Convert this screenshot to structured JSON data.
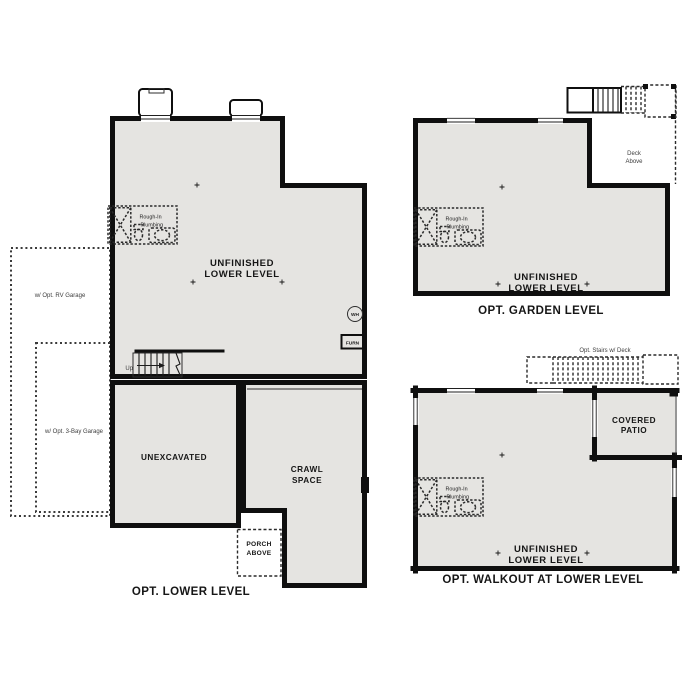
{
  "colors": {
    "wall": "#0f0f0f",
    "floor": "#e5e4e1",
    "floor_light": "#f2f1ef",
    "dash": "#2a2a2a"
  },
  "plans": {
    "lower": {
      "title": "OPT. LOWER LEVEL",
      "labels": {
        "unfinished_1": "UNFINISHED",
        "unfinished_2": "LOWER LEVEL",
        "unexcavated": "UNEXCAVATED",
        "crawl_1": "CRAWL",
        "crawl_2": "SPACE",
        "porch_1": "PORCH",
        "porch_2": "ABOVE"
      },
      "annotations": {
        "rough_in_1": "Rough-In",
        "rough_in_2": "Plumbing",
        "rv_garage": "w/ Opt. RV Garage",
        "three_bay_garage": "w/ Opt. 3-Bay Garage",
        "up": "Up",
        "water_heater": "WH",
        "furnace": "FURN"
      }
    },
    "garden": {
      "title": "OPT. GARDEN LEVEL",
      "labels": {
        "unfinished_1": "UNFINISHED",
        "unfinished_2": "LOWER LEVEL",
        "deck_1": "Deck",
        "deck_2": "Above"
      },
      "annotations": {
        "rough_in_1": "Rough-In",
        "rough_in_2": "Plumbing"
      }
    },
    "walkout": {
      "title": "OPT. WALKOUT AT LOWER LEVEL",
      "labels": {
        "unfinished_1": "UNFINISHED",
        "unfinished_2": "LOWER LEVEL",
        "patio_1": "COVERED",
        "patio_2": "PATIO"
      },
      "annotations": {
        "rough_in_1": "Rough-In",
        "rough_in_2": "Plumbing",
        "opt_stairs": "Opt. Stairs w/ Deck"
      }
    }
  }
}
